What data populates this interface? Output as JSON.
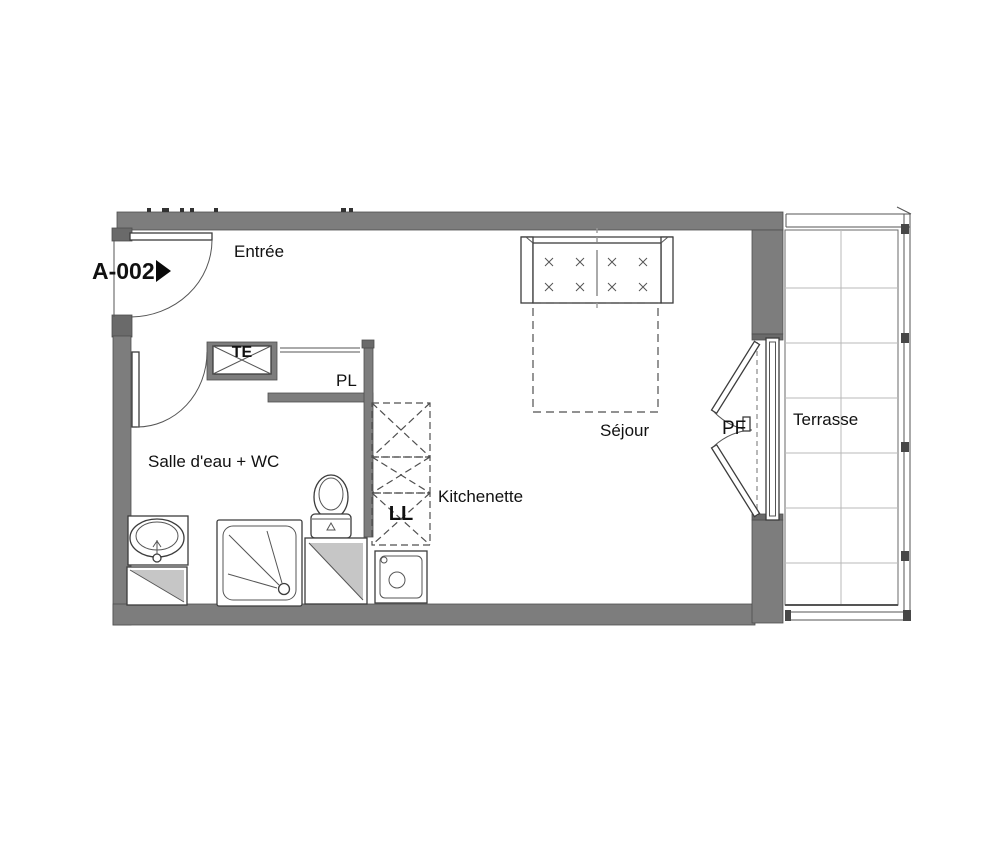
{
  "floorplan": {
    "apartment_id": "A-002",
    "labels": {
      "entree": "Entrée",
      "te": "TE",
      "pl": "PL",
      "salle_deau": "Salle d'eau + WC",
      "ll": "LL",
      "kitchenette": "Kitchenette",
      "sejour": "Séjour",
      "pf": "PF",
      "terrasse": "Terrasse"
    },
    "colors": {
      "wall": "#7d7d7d",
      "wall_dark": "#6a6a6a",
      "line": "#3c3c3c",
      "shaft_fill": "#c6c6c6",
      "grid": "#b9b9b9",
      "background": "#ffffff",
      "text": "#111111"
    }
  }
}
